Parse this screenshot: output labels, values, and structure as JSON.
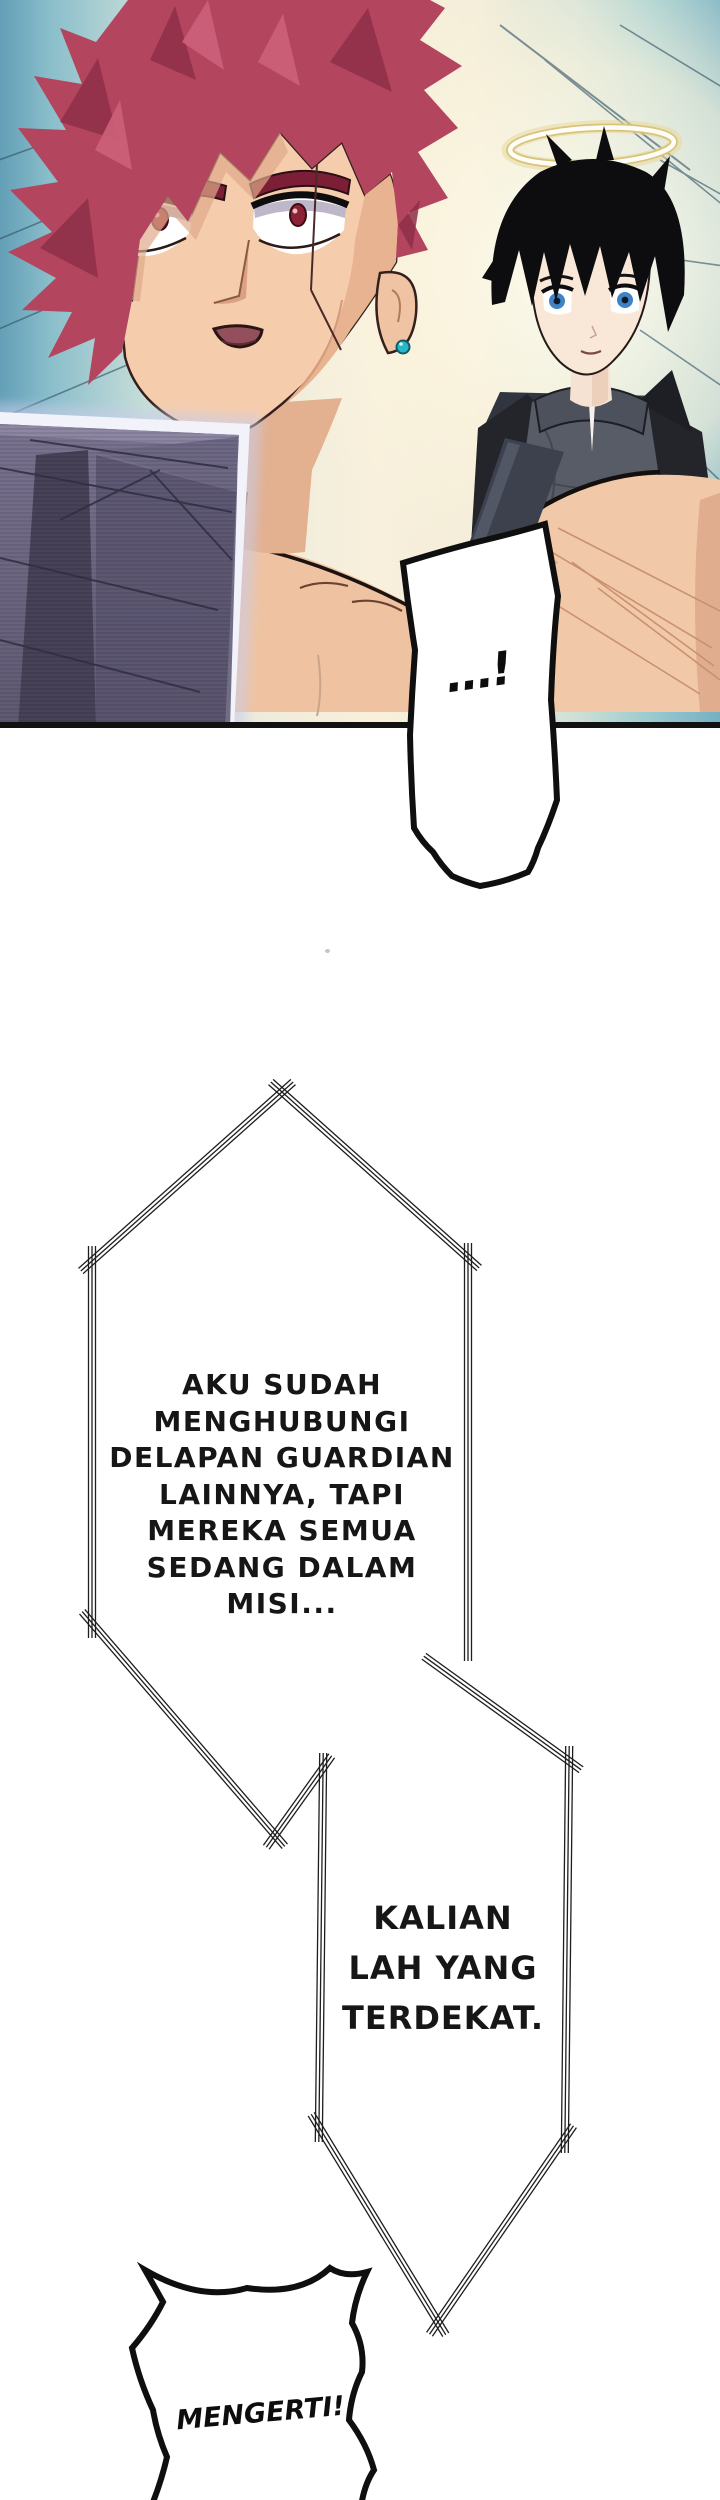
{
  "dialog": {
    "shock": {
      "text": "...!"
    },
    "bubble1": {
      "lines": [
        "AKU SUDAH",
        "MENGHUBUNGI",
        "DELAPAN GUARDIAN",
        "LAINNYA, TAPI",
        "MEREKA SEMUA",
        "SEDANG DALAM",
        "MISI..."
      ]
    },
    "bubble2": {
      "lines": [
        "KALIAN",
        "LAH YANG",
        "TERDEKAT."
      ]
    },
    "shout": {
      "text": "MENGERTI!"
    }
  },
  "scene": {
    "description": "manga panel with two characters",
    "icons": [
      "halo-icon",
      "hologram-screen",
      "speed-lines"
    ],
    "colors": {
      "hair_red": "#b4455e",
      "hair_red_dark": "#8e2f48",
      "skin": "#f4cbaa",
      "skin_shadow": "#d9a183",
      "background_teal": "#7db6c6",
      "background_cream": "#f7efdc",
      "halo_gold": "#d9c27c",
      "hair_black": "#0d0d0f",
      "eye_blue": "#3f83c4",
      "eye_red": "#8c2236",
      "jacket_dark": "#2b2e35",
      "shirt_gray": "#575c66",
      "screen_purple": "#5b5570",
      "earring_teal": "#27b7c8",
      "ink": "#0f0f0f"
    }
  }
}
